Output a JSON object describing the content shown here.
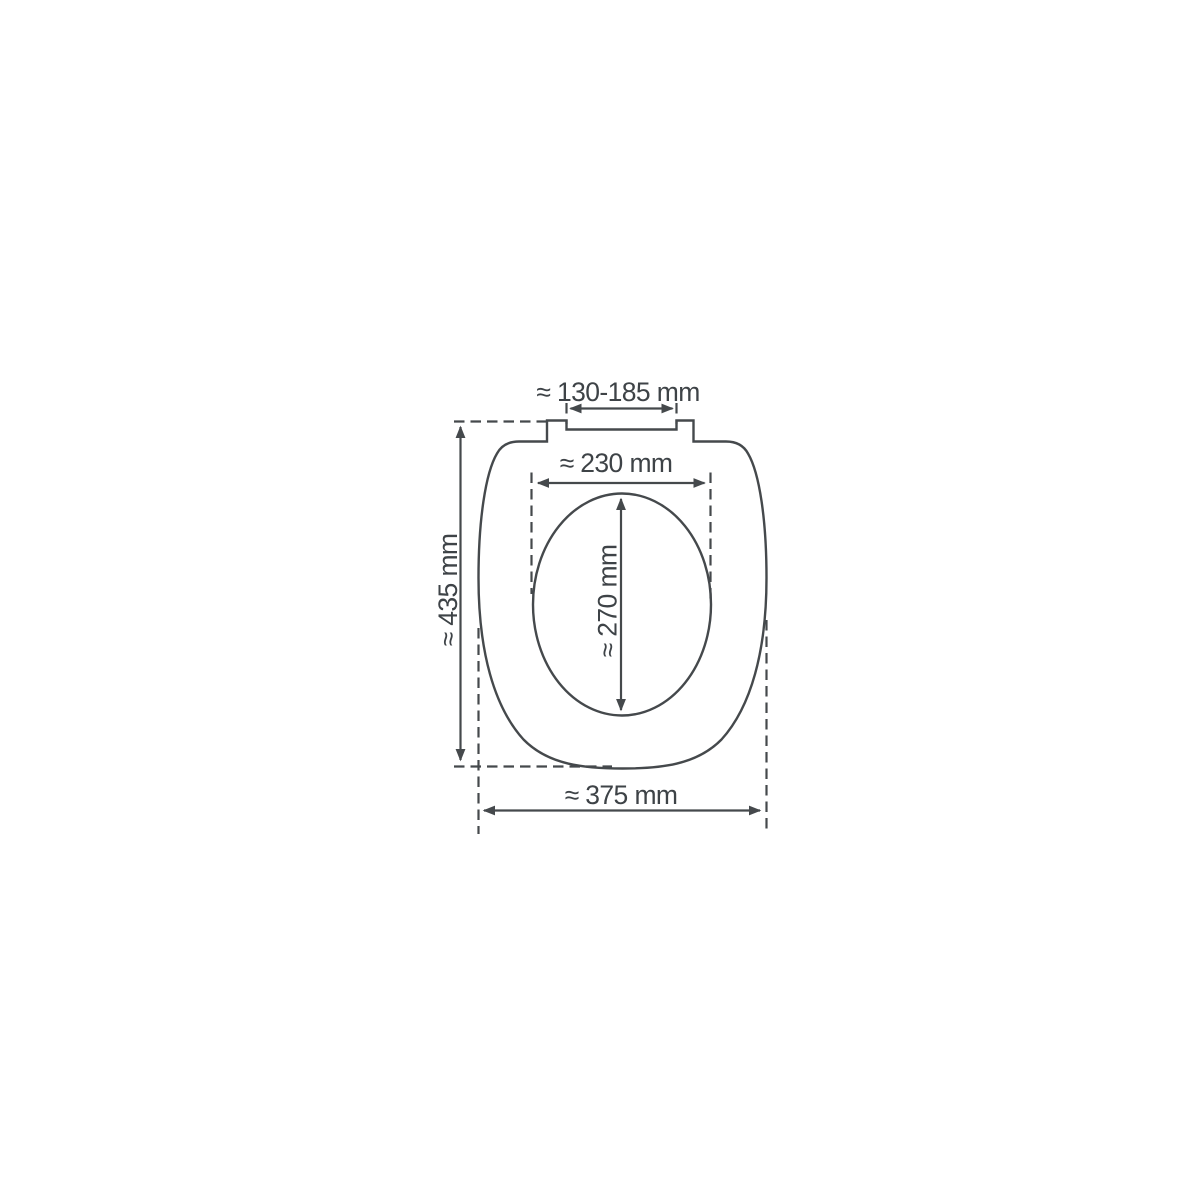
{
  "diagram": {
    "title": "Toilet seat dimension drawing (top view)",
    "stroke_color": "#45494c",
    "text_color": "#3e4347",
    "background_color": "#ffffff",
    "labels": {
      "hinge_width": "≈ 130-185 mm",
      "inner_width": "≈ 230 mm",
      "inner_length": "≈ 270 mm",
      "overall_length": "≈ 435 mm",
      "overall_width": "≈ 375 mm"
    },
    "units": "mm"
  }
}
